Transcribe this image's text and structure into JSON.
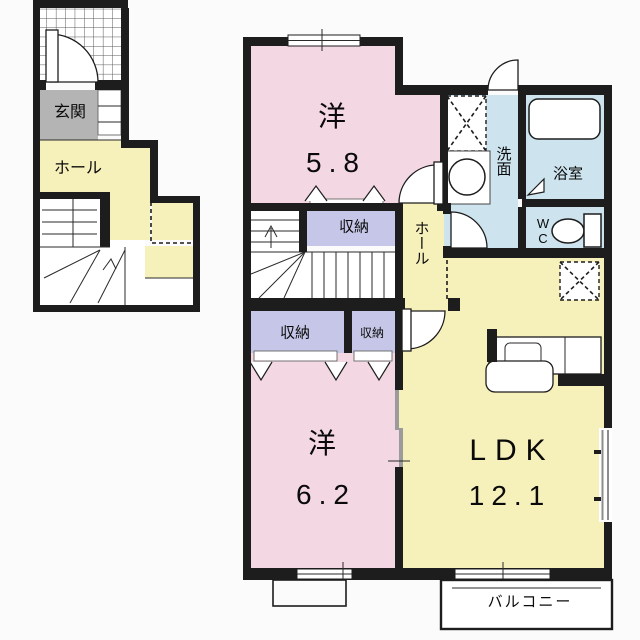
{
  "colors": {
    "wall": "#1d1d1d",
    "room_pink": "#f3d7e3",
    "room_yellow": "#f6f0ba",
    "storage_purple": "#c6c6e8",
    "wet_area_blue": "#cde4ef",
    "entrance_gray": "#b4b4b4"
  },
  "first_floor": {
    "entrance": "玄関",
    "hall": "ホール"
  },
  "second_floor": {
    "room1_name": "洋",
    "room1_area": "5.8",
    "room2_name": "洋",
    "room2_area": "6.2",
    "ldk_name": "LDK",
    "ldk_area": "12.1",
    "hall": "ホール",
    "washroom": "洗面",
    "bathroom": "浴室",
    "wc": "WC",
    "storage_top": "収納",
    "storage_left": "収納",
    "storage_right": "収納",
    "balcony": "バルコニー"
  }
}
